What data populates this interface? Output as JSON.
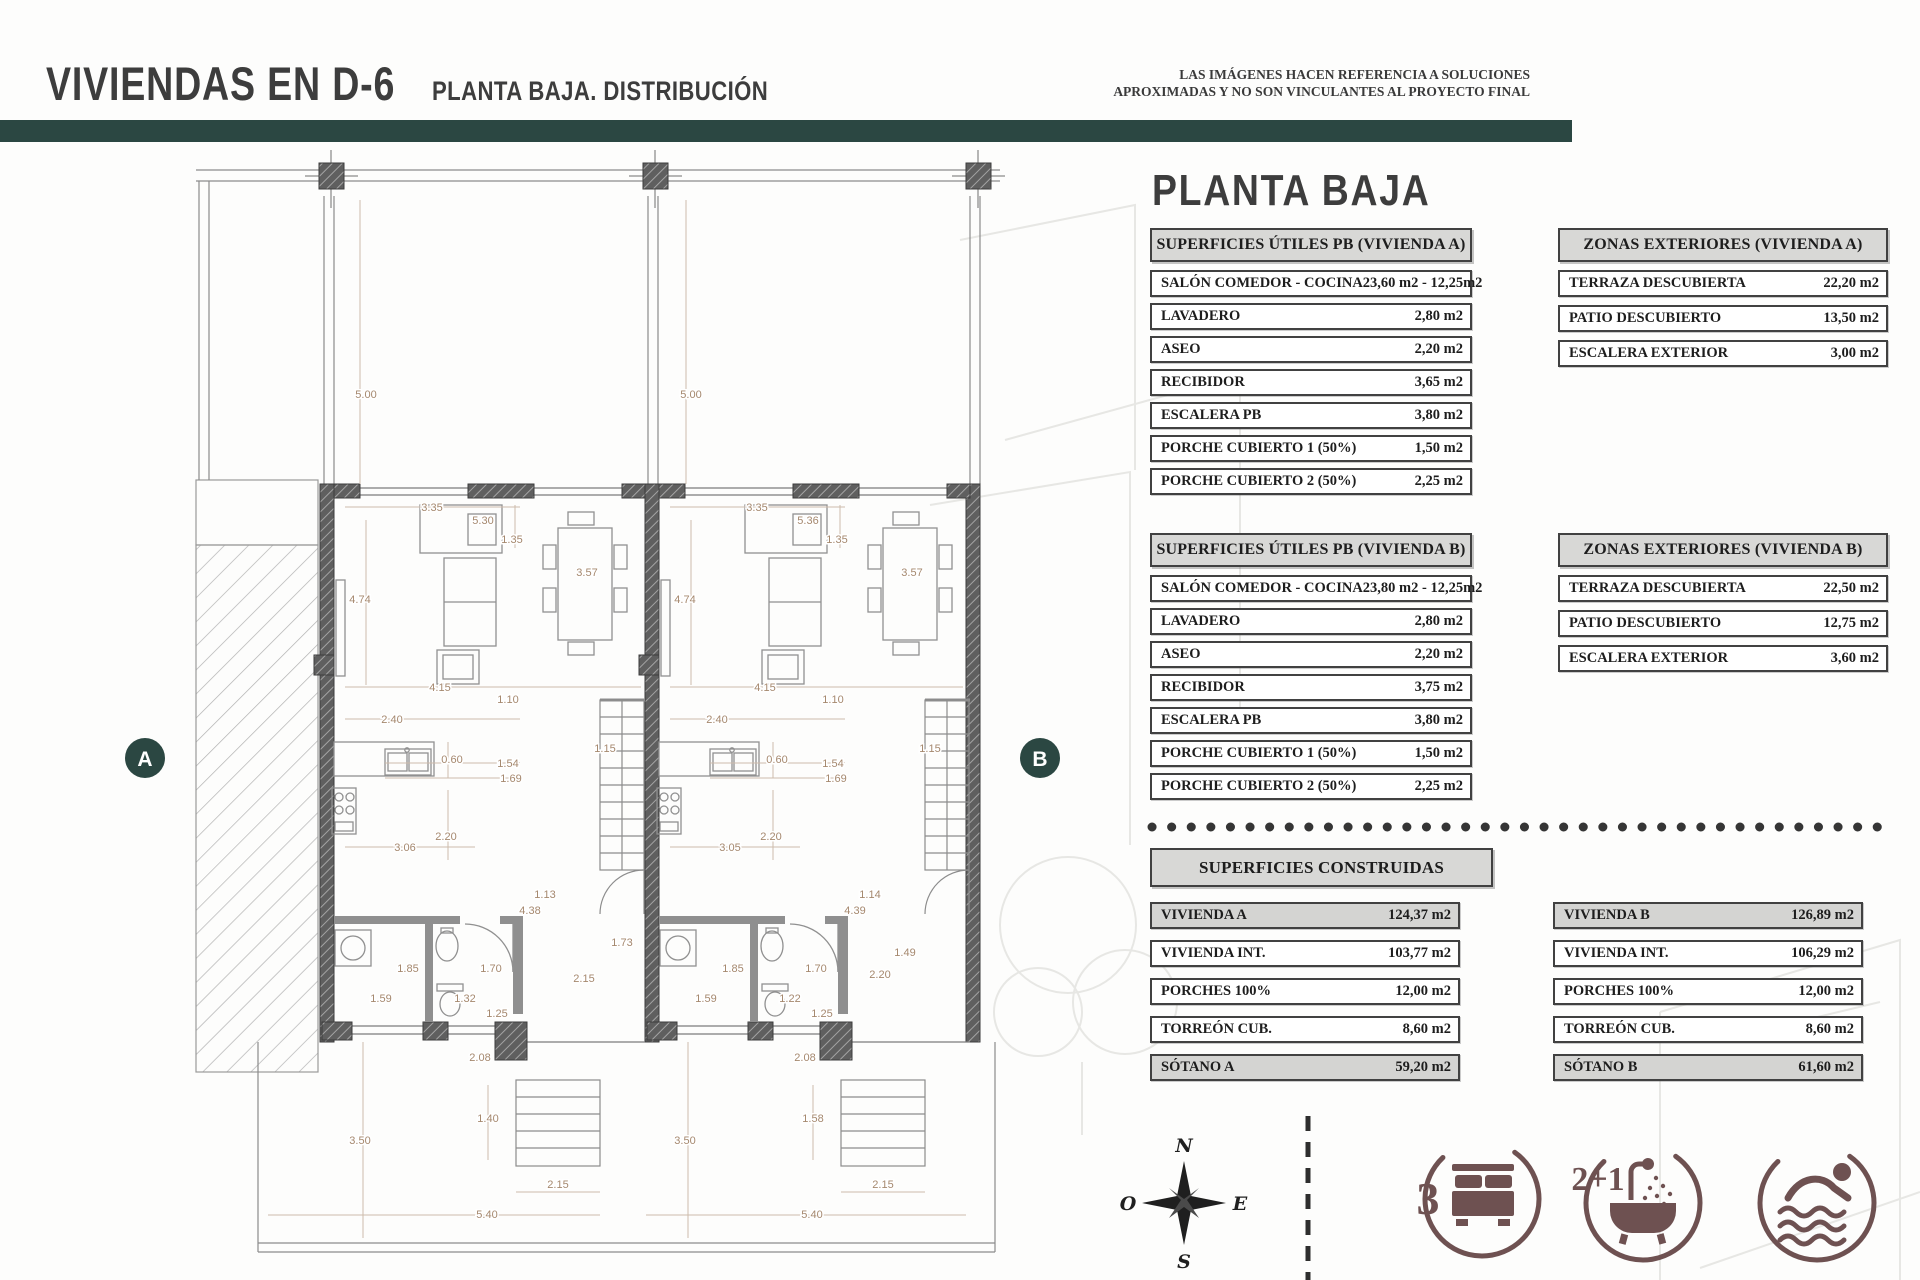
{
  "header": {
    "title": "VIVIENDAS EN D-6",
    "subtitle": "PLANTA BAJA. DISTRIBUCIÓN",
    "disclaimer1": "LAS IMÁGENES HACEN REFERENCIA A SOLUCIONES",
    "disclaimer2": "APROXIMADAS Y NO SON VINCULANTES AL PROYECTO FINAL"
  },
  "panel": {
    "title": "PLANTA BAJA",
    "tables": {
      "utiles_a": {
        "header": "SUPERFICIES ÚTILES PB (VIVIENDA A)",
        "rows": [
          {
            "label": "SALÓN COMEDOR - COCINA",
            "value": "23,60 m2 - 12,25m2"
          },
          {
            "label": "LAVADERO",
            "value": "2,80 m2"
          },
          {
            "label": "ASEO",
            "value": "2,20 m2"
          },
          {
            "label": "RECIBIDOR",
            "value": "3,65 m2"
          },
          {
            "label": "ESCALERA PB",
            "value": "3,80 m2"
          },
          {
            "label": "PORCHE CUBIERTO 1 (50%)",
            "value": "1,50 m2"
          },
          {
            "label": "PORCHE CUBIERTO 2 (50%)",
            "value": "2,25 m2"
          }
        ]
      },
      "zonas_a": {
        "header": "ZONAS EXTERIORES (VIVIENDA A)",
        "rows": [
          {
            "label": "TERRAZA DESCUBIERTA",
            "value": "22,20 m2"
          },
          {
            "label": "PATIO DESCUBIERTO",
            "value": "13,50 m2"
          },
          {
            "label": "ESCALERA EXTERIOR",
            "value": "3,00 m2"
          }
        ]
      },
      "utiles_b": {
        "header": "SUPERFICIES ÚTILES PB (VIVIENDA B)",
        "rows": [
          {
            "label": "SALÓN COMEDOR - COCINA",
            "value": "23,80 m2 - 12,25m2"
          },
          {
            "label": "LAVADERO",
            "value": "2,80 m2"
          },
          {
            "label": "ASEO",
            "value": "2,20 m2"
          },
          {
            "label": "RECIBIDOR",
            "value": "3,75 m2"
          },
          {
            "label": "ESCALERA PB",
            "value": "3,80 m2"
          },
          {
            "label": "PORCHE CUBIERTO 1 (50%)",
            "value": "1,50 m2"
          },
          {
            "label": "PORCHE CUBIERTO 2 (50%)",
            "value": "2,25 m2"
          }
        ]
      },
      "zonas_b": {
        "header": "ZONAS EXTERIORES (VIVIENDA B)",
        "rows": [
          {
            "label": "TERRAZA DESCUBIERTA",
            "value": "22,50 m2"
          },
          {
            "label": "PATIO DESCUBIERTO",
            "value": "12,75 m2"
          },
          {
            "label": "ESCALERA EXTERIOR",
            "value": "3,60 m2"
          }
        ]
      },
      "construidas": {
        "header": "SUPERFICIES CONSTRUIDAS"
      },
      "construidas_a": {
        "rows": [
          {
            "label": "VIVIENDA A",
            "value": "124,37 m2",
            "shaded": true
          },
          {
            "label": "VIVIENDA INT.",
            "value": "103,77 m2"
          },
          {
            "label": "PORCHES 100%",
            "value": "12,00 m2"
          },
          {
            "label": "TORREÓN CUB.",
            "value": "8,60 m2"
          },
          {
            "label": "SÓTANO A",
            "value": "59,20 m2",
            "shaded": true
          }
        ]
      },
      "construidas_b": {
        "rows": [
          {
            "label": "VIVIENDA B",
            "value": "126,89 m2",
            "shaded": true
          },
          {
            "label": "VIVIENDA INT.",
            "value": "106,29 m2"
          },
          {
            "label": "PORCHES 100%",
            "value": "12,00 m2"
          },
          {
            "label": "TORREÓN CUB.",
            "value": "8,60 m2"
          },
          {
            "label": "SÓTANO B",
            "value": "61,60 m2",
            "shaded": true
          }
        ]
      }
    }
  },
  "features": {
    "bedrooms": "3",
    "bathrooms": "2+1"
  },
  "compass": {
    "n": "N",
    "s": "S",
    "e": "E",
    "w": "O"
  },
  "plan": {
    "badge_a": "A",
    "badge_b": "B",
    "dimensions": [
      {
        "t": "5.00",
        "x": 366,
        "y": 398
      },
      {
        "t": "5.00",
        "x": 691,
        "y": 398
      },
      {
        "t": "3.35",
        "x": 432,
        "y": 511
      },
      {
        "t": "3.35",
        "x": 757,
        "y": 511
      },
      {
        "t": "5.30",
        "x": 483,
        "y": 524
      },
      {
        "t": "5.36",
        "x": 808,
        "y": 524
      },
      {
        "t": "1.35",
        "x": 512,
        "y": 543
      },
      {
        "t": "1.35",
        "x": 837,
        "y": 543
      },
      {
        "t": "3.57",
        "x": 587,
        "y": 576
      },
      {
        "t": "3.57",
        "x": 912,
        "y": 576
      },
      {
        "t": "4.74",
        "x": 360,
        "y": 603
      },
      {
        "t": "4.74",
        "x": 685,
        "y": 603
      },
      {
        "t": "4.15",
        "x": 440,
        "y": 691
      },
      {
        "t": "4.15",
        "x": 765,
        "y": 691
      },
      {
        "t": "1.10",
        "x": 508,
        "y": 703
      },
      {
        "t": "1.10",
        "x": 833,
        "y": 703
      },
      {
        "t": "2.40",
        "x": 392,
        "y": 723
      },
      {
        "t": "2.40",
        "x": 717,
        "y": 723
      },
      {
        "t": "1.15",
        "x": 605,
        "y": 752
      },
      {
        "t": "1.15",
        "x": 930,
        "y": 752
      },
      {
        "t": "0.60",
        "x": 452,
        "y": 763
      },
      {
        "t": "0.60",
        "x": 777,
        "y": 763
      },
      {
        "t": "1.54",
        "x": 508,
        "y": 767
      },
      {
        "t": "1.54",
        "x": 833,
        "y": 767
      },
      {
        "t": "1.69",
        "x": 511,
        "y": 782
      },
      {
        "t": "1.69",
        "x": 836,
        "y": 782
      },
      {
        "t": "2.20",
        "x": 446,
        "y": 840
      },
      {
        "t": "2.20",
        "x": 771,
        "y": 840
      },
      {
        "t": "3.06",
        "x": 405,
        "y": 851
      },
      {
        "t": "3.05",
        "x": 730,
        "y": 851
      },
      {
        "t": "1.13",
        "x": 545,
        "y": 898
      },
      {
        "t": "1.14",
        "x": 870,
        "y": 898
      },
      {
        "t": "4.38",
        "x": 530,
        "y": 914
      },
      {
        "t": "4.39",
        "x": 855,
        "y": 914
      },
      {
        "t": "1.73",
        "x": 622,
        "y": 946
      },
      {
        "t": "1.49",
        "x": 905,
        "y": 956
      },
      {
        "t": "1.85",
        "x": 408,
        "y": 972
      },
      {
        "t": "1.85",
        "x": 733,
        "y": 972
      },
      {
        "t": "1.70",
        "x": 491,
        "y": 972
      },
      {
        "t": "1.70",
        "x": 816,
        "y": 972
      },
      {
        "t": "2.15",
        "x": 584,
        "y": 982
      },
      {
        "t": "2.20",
        "x": 880,
        "y": 978
      },
      {
        "t": "1.59",
        "x": 381,
        "y": 1002
      },
      {
        "t": "1.59",
        "x": 706,
        "y": 1002
      },
      {
        "t": "1.32",
        "x": 465,
        "y": 1002
      },
      {
        "t": "1.22",
        "x": 790,
        "y": 1002
      },
      {
        "t": "1.25",
        "x": 497,
        "y": 1017
      },
      {
        "t": "1.25",
        "x": 822,
        "y": 1017
      },
      {
        "t": "2.08",
        "x": 480,
        "y": 1061
      },
      {
        "t": "2.08",
        "x": 805,
        "y": 1061
      },
      {
        "t": "1.40",
        "x": 488,
        "y": 1122
      },
      {
        "t": "1.58",
        "x": 813,
        "y": 1122
      },
      {
        "t": "3.50",
        "x": 360,
        "y": 1144
      },
      {
        "t": "3.50",
        "x": 685,
        "y": 1144
      },
      {
        "t": "2.15",
        "x": 558,
        "y": 1188
      },
      {
        "t": "2.15",
        "x": 883,
        "y": 1188
      },
      {
        "t": "5.40",
        "x": 487,
        "y": 1218
      },
      {
        "t": "5.40",
        "x": 812,
        "y": 1218
      }
    ]
  },
  "colors": {
    "teal": "#2b4742",
    "icon_brown": "#6e5151",
    "dim_text": "#a5886e"
  }
}
